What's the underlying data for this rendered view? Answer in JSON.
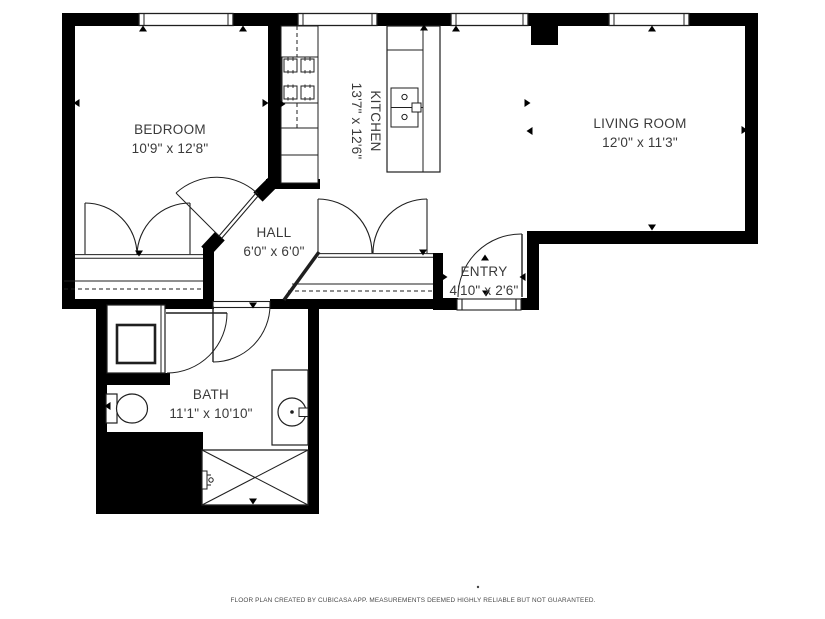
{
  "rooms": {
    "bedroom": {
      "name": "BEDROOM",
      "dims": "10'9\" x 12'8\""
    },
    "kitchen": {
      "name": "KITCHEN",
      "dims": "13'7\" x 12'6\""
    },
    "living_room": {
      "name": "LIVING ROOM",
      "dims": "12'0\" x 11'3\""
    },
    "hall": {
      "name": "HALL",
      "dims": "6'0\" x 6'0\""
    },
    "entry": {
      "name": "ENTRY",
      "dims": "4'10\" x 2'6\""
    },
    "bath": {
      "name": "BATH",
      "dims": "11'1\" x 10'10\""
    }
  },
  "footer": {
    "disclaimer": "FLOOR PLAN CREATED BY CUBICASA APP. MEASUREMENTS DEEMED HIGHLY RELIABLE BUT NOT GUARANTEED."
  },
  "fixtures": {
    "kitchen": [
      "stove-icon",
      "counter",
      "kitchen-island",
      "kitchen-sink-icon"
    ],
    "bath": [
      "shower-icon",
      "toilet-icon",
      "vanity-sink-icon",
      "bathtub-icon"
    ],
    "closets": [
      "bedroom-closet",
      "hall-closet"
    ]
  },
  "colors": {
    "wall": "#000000",
    "line": "#1f1f1f",
    "text": "#3a3a3a",
    "background": "#ffffff"
  }
}
